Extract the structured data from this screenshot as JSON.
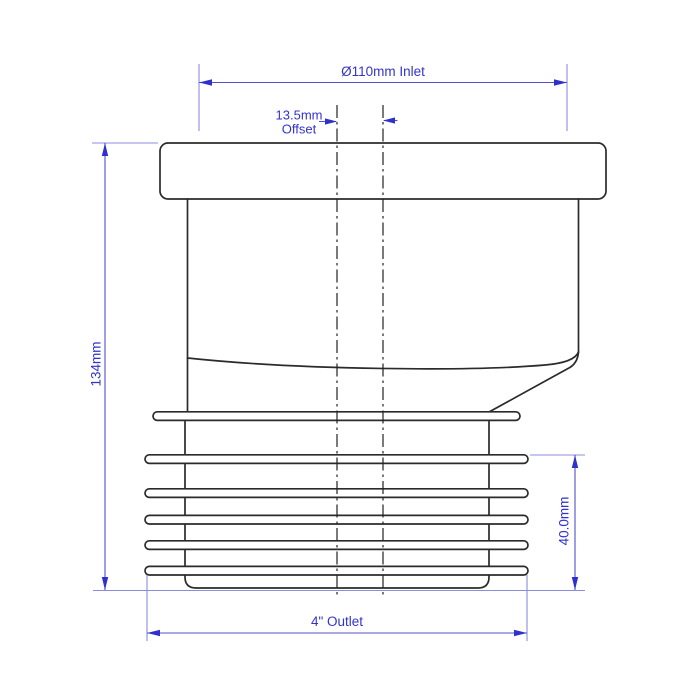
{
  "canvas": {
    "width": 700,
    "height": 700,
    "background": "#ffffff"
  },
  "colors": {
    "drawing_line": "#2b2b2b",
    "dimension_line": "#5050cf",
    "extension_line": "#8c8cdc",
    "dimension_text": "#3333cc",
    "arrowhead": "#3030cd"
  },
  "dimensions": {
    "inlet": {
      "label": "Ø110mm Inlet",
      "value_mm": 110
    },
    "offset": {
      "line1": "13.5mm",
      "line2": "Offset",
      "value_mm": 13.5
    },
    "overall_height": {
      "label": "134mm",
      "value_mm": 134
    },
    "seal_section_height": {
      "label": "40.0mm",
      "value_mm": 40.0
    },
    "outlet": {
      "label": "4\" Outlet",
      "value_inches": 4
    }
  }
}
